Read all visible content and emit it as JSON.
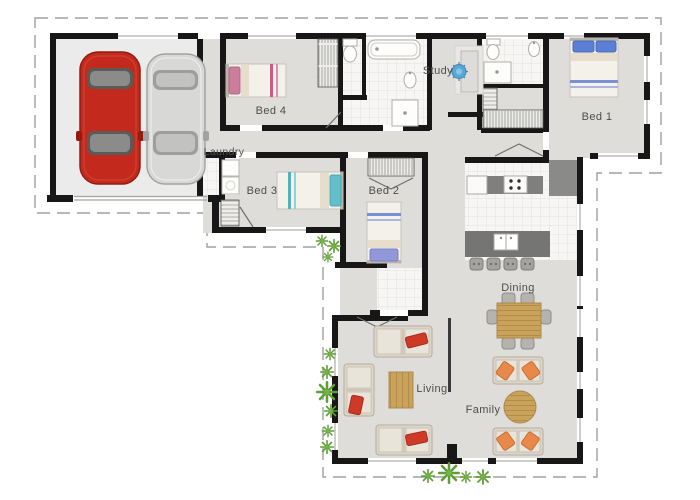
{
  "floorplan": {
    "labels": {
      "bed1": "Bed 1",
      "bed2": "Bed 2",
      "bed3": "Bed 3",
      "bed4": "Bed 4",
      "study": "Study",
      "laundry": "Laundry",
      "dining": "Dining",
      "living": "Living",
      "family": "Family"
    },
    "colors": {
      "wall": "#171717",
      "floor": "#dfddd9",
      "garage_floor": "#ebebeb",
      "tile": "#f7f6f4",
      "boundary_dash": "#a0a0a0",
      "label_text": "#4d4d4d",
      "car_red": "#c32a1d",
      "car_silver": "#d8d8d6",
      "wood": "#c9a25c",
      "counter_gray": "#7f7f7d",
      "sofa_beige": "#ddd6ca",
      "cushion_red": "#cf3a28",
      "cushion_orange": "#e8884a",
      "plant_green": "#5d9e35",
      "pillow_pink": "#cb7d9b",
      "pillow_teal": "#62bec8",
      "pillow_lavender": "#9197d8",
      "pillow_blue": "#5b7fd4",
      "study_chair_blue": "#5aa7d6"
    }
  }
}
